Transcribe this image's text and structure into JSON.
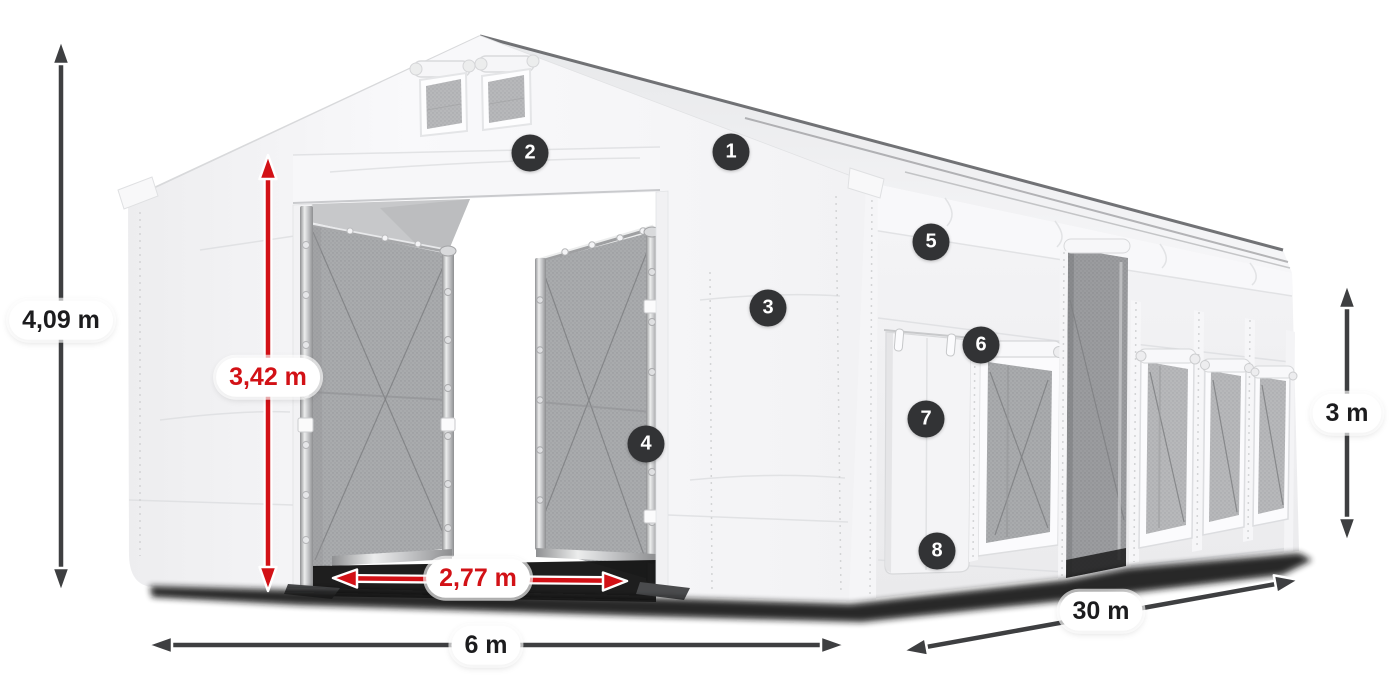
{
  "dimensions": {
    "total_height": {
      "label": "4,09 m"
    },
    "door_height": {
      "label": "3,42 m"
    },
    "door_clear_width": {
      "label": "2,77 m"
    },
    "width": {
      "label": "6 m"
    },
    "length": {
      "label": "30 m"
    },
    "side_height": {
      "label": "3 m"
    }
  },
  "callouts": [
    {
      "number": "1"
    },
    {
      "number": "2"
    },
    {
      "number": "3"
    },
    {
      "number": "4"
    },
    {
      "number": "5"
    },
    {
      "number": "6"
    },
    {
      "number": "7"
    },
    {
      "number": "8"
    }
  ],
  "colors": {
    "accent_red": "#d21116",
    "arrow_dark": "#3e3f41",
    "badge_bg": "#323335",
    "label_text": "#1c1c1e",
    "page_bg": "#ffffff"
  }
}
